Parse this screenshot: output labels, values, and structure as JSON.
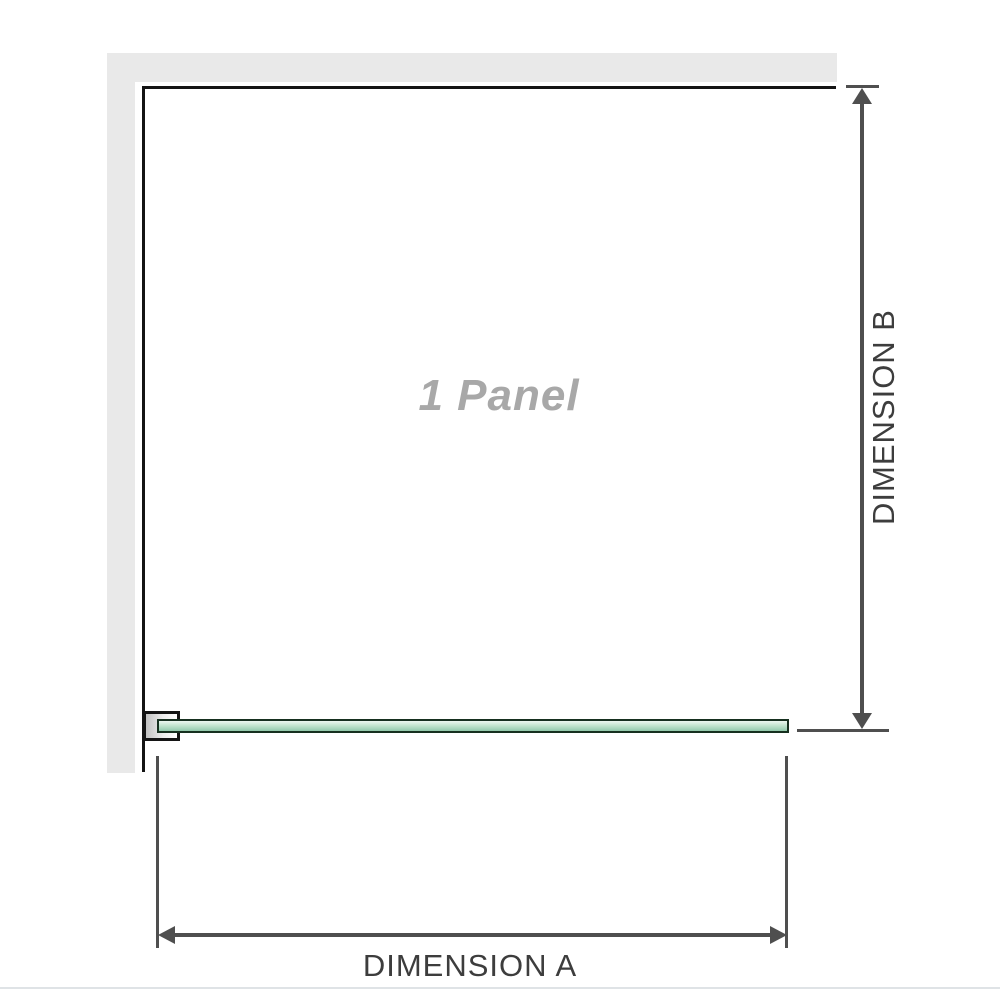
{
  "labels": {
    "panel": "1 Panel",
    "dimension_a": "DIMENSION A",
    "dimension_b": "DIMENSION B"
  },
  "colors": {
    "wall": "#e9e9e9",
    "outline": "#141414",
    "dimension_line": "#4f4f4f",
    "dimension_text": "#3d3d3d",
    "panel_text": "#a8a8a8",
    "glass_border": "#16301f",
    "glass_top": "#edf7f0",
    "glass_mid": "#c3e5cf",
    "glass_bottom": "#92c9ab",
    "bracket_fill_start": "#c2c2c2",
    "bracket_fill_end": "#ffffff",
    "page_edge": "#dfe3e6"
  }
}
